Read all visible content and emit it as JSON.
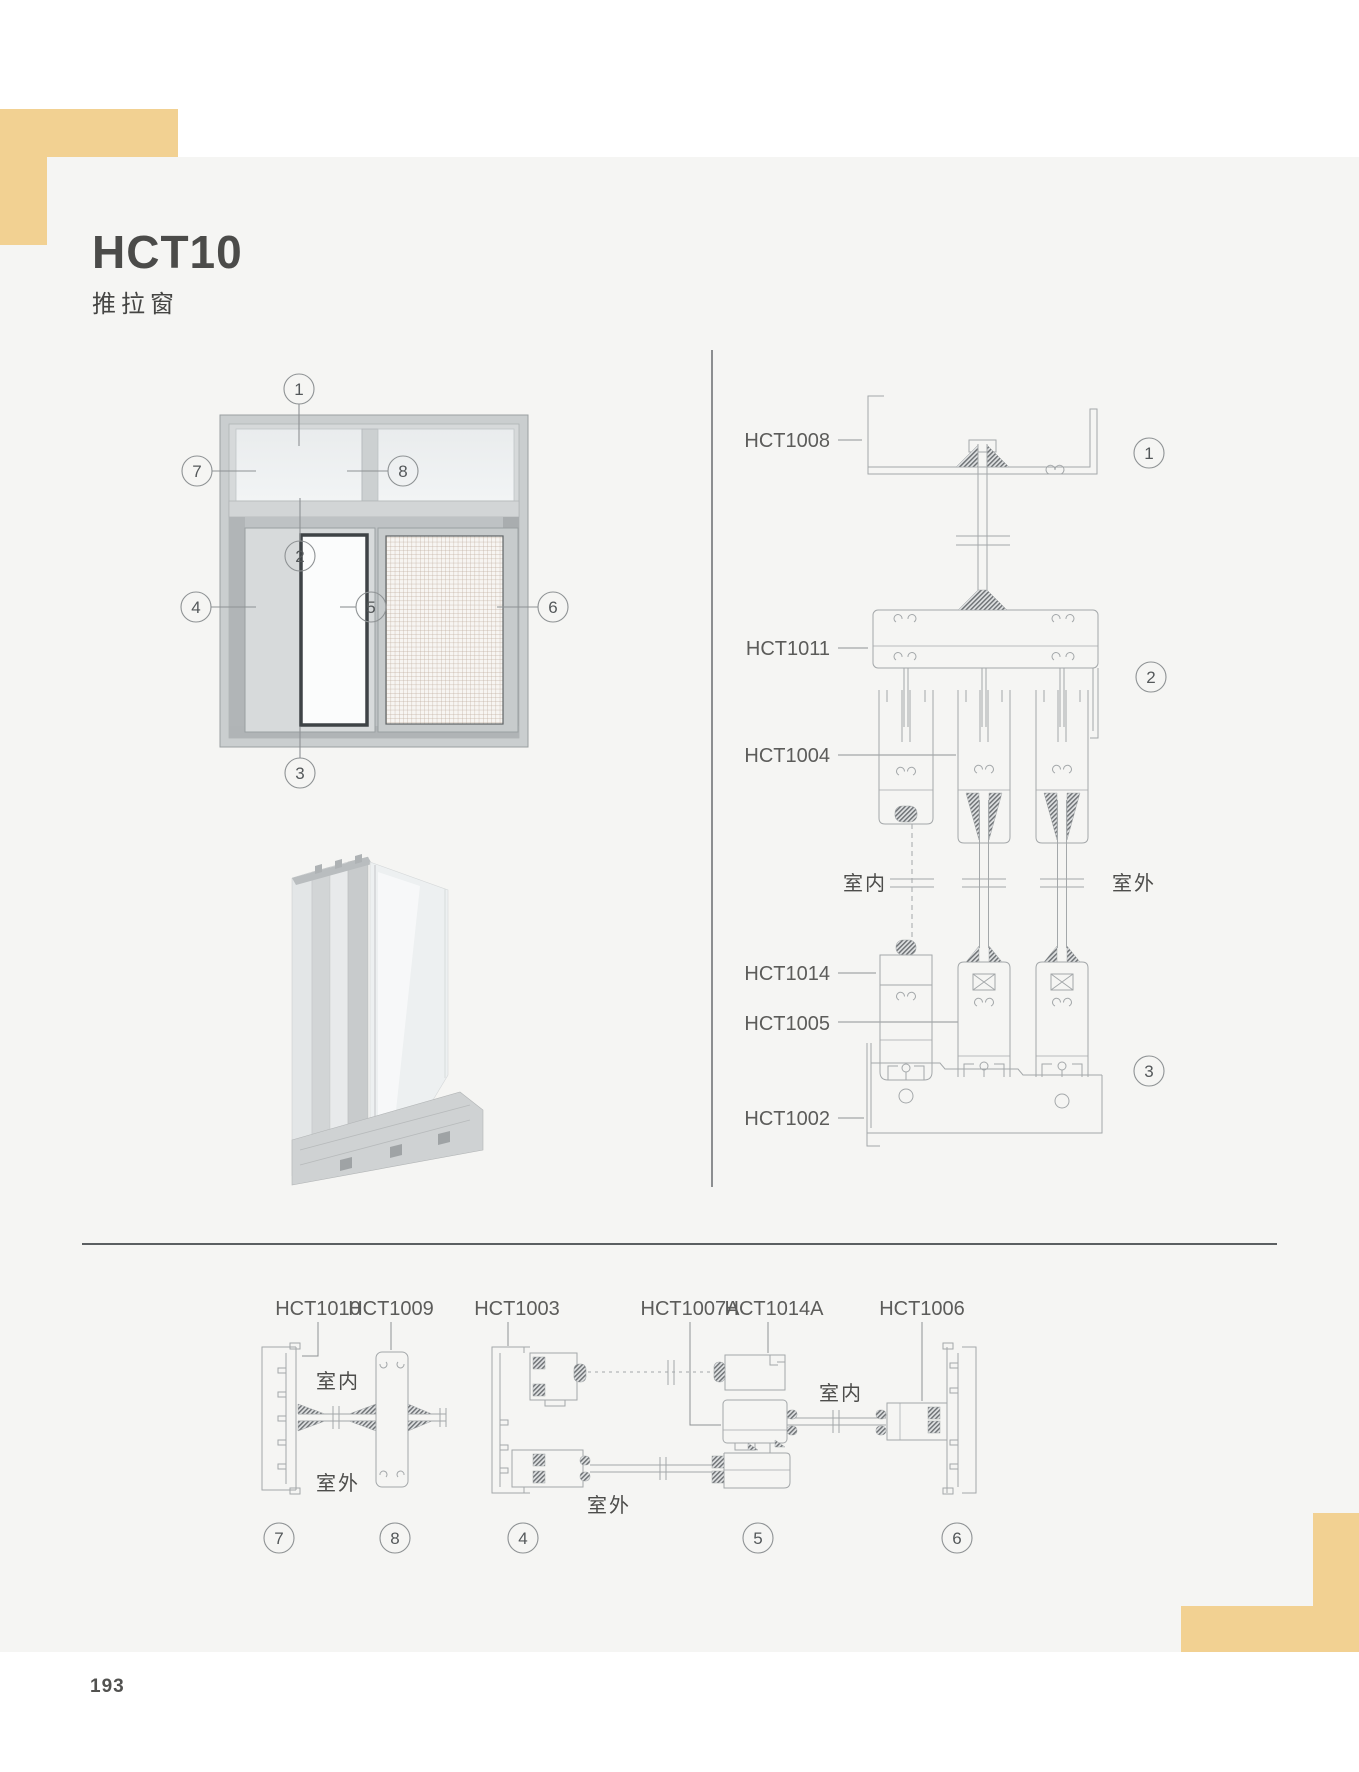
{
  "page": {
    "title": "HCT10",
    "subtitle": "推拉窗",
    "page_number": "193"
  },
  "elevation": {
    "callouts": [
      "1",
      "2",
      "3",
      "4",
      "5",
      "6",
      "7",
      "8"
    ]
  },
  "vertical_section": {
    "labels": [
      "HCT1008",
      "HCT1011",
      "HCT1004",
      "HCT1014",
      "HCT1005",
      "HCT1002"
    ],
    "indoor_label": "室内",
    "outdoor_label": "室外",
    "callouts": [
      "1",
      "2",
      "3"
    ]
  },
  "horizontal_sections": {
    "left_group": {
      "labels": [
        "HCT1010",
        "HCT1009"
      ],
      "indoor_label": "室内",
      "outdoor_label": "室外",
      "callouts": [
        "7",
        "8"
      ]
    },
    "right_group": {
      "labels": [
        "HCT1003",
        "HCT1007A",
        "HCT1014A",
        "HCT1006"
      ],
      "indoor_label": "室内",
      "outdoor_label": "室外",
      "callouts": [
        "4",
        "5",
        "6"
      ]
    }
  },
  "colors": {
    "accent_yellow": "#f2d192",
    "panel_background": "#f5f5f3",
    "drawing_line": "#a4a8aa",
    "text_dark": "#4b4b49"
  }
}
